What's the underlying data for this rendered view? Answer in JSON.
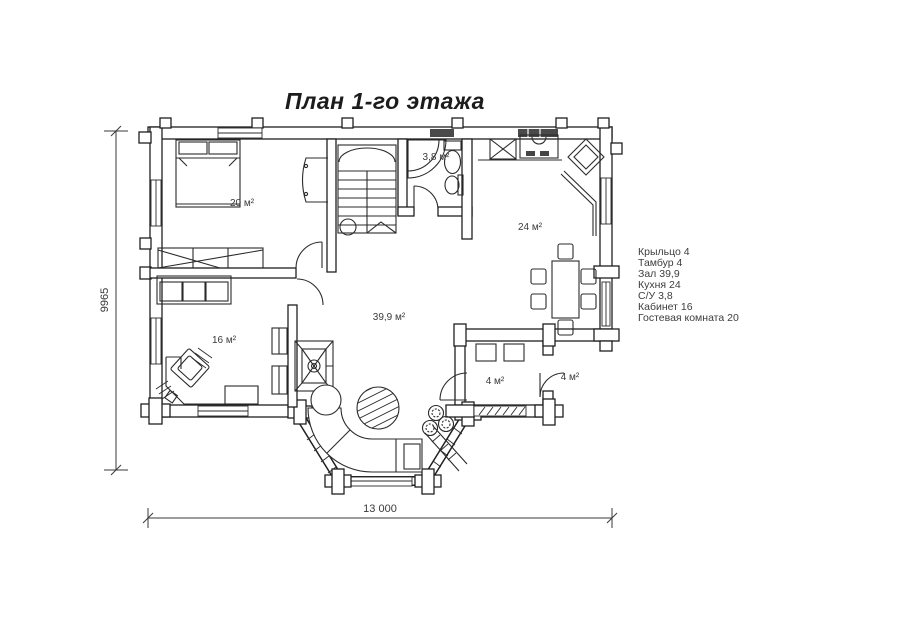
{
  "title": "План 1-го этажа",
  "legend": {
    "items": [
      {
        "label": "Крыльцо 4"
      },
      {
        "label": "Тамбур 4"
      },
      {
        "label": "Зал 39,9"
      },
      {
        "label": "Кухня 24"
      },
      {
        "label": "С/У 3,8"
      },
      {
        "label": "Кабинет 16"
      },
      {
        "label": "Гостевая комната 20"
      }
    ]
  },
  "room_labels": {
    "guest_room": "20 м²",
    "bathroom": "3,8 м²",
    "kitchen": "24 м²",
    "hall": "39,9 м²",
    "office": "16 м²",
    "tambour": "4 м²",
    "porch": "4 м²"
  },
  "dimensions": {
    "total_width": "13 000",
    "total_height": "9965"
  },
  "colors": {
    "line": "#1f1f1f",
    "background": "#ffffff",
    "text": "#3d3d3d"
  }
}
